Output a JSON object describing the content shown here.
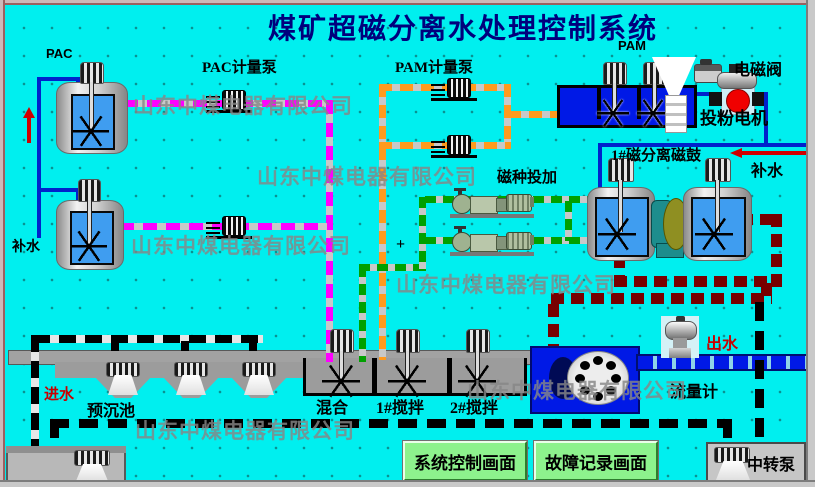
{
  "title": "煤矿超磁分离水处理控制系统",
  "watermark": "山东中煤电器有限公司",
  "labels": {
    "pac": "PAC",
    "pac_pump": "PAC计量泵",
    "pam_pump": "PAM计量泵",
    "pam": "PAM",
    "solenoid_valve": "电磁阀",
    "powder_motor": "投粉电机",
    "mag_separator": "1#磁分离磁鼓",
    "makeup_water": "补水",
    "seed_dosing": "磁种投加",
    "inlet": "进水",
    "presed": "预沉池",
    "mix": "混合",
    "stir1": "1#搅拌",
    "stir2": "2#搅拌",
    "outlet": "出水",
    "flow_meter": "流量计",
    "transfer_pump": "中转泵",
    "plus": "+"
  },
  "buttons": {
    "system_control": "系统控制画面",
    "fault_record": "故障记录画面"
  },
  "colors": {
    "background": "#00efef",
    "title": "#00007d",
    "pac_line": "#ff00ff",
    "pam_line": "#ff9a1e",
    "seed_line": "#00a000",
    "sludge_line": "#780000",
    "water_pipe": "#0022cc",
    "button": "#8df28d",
    "alert_text": "#c80000"
  }
}
